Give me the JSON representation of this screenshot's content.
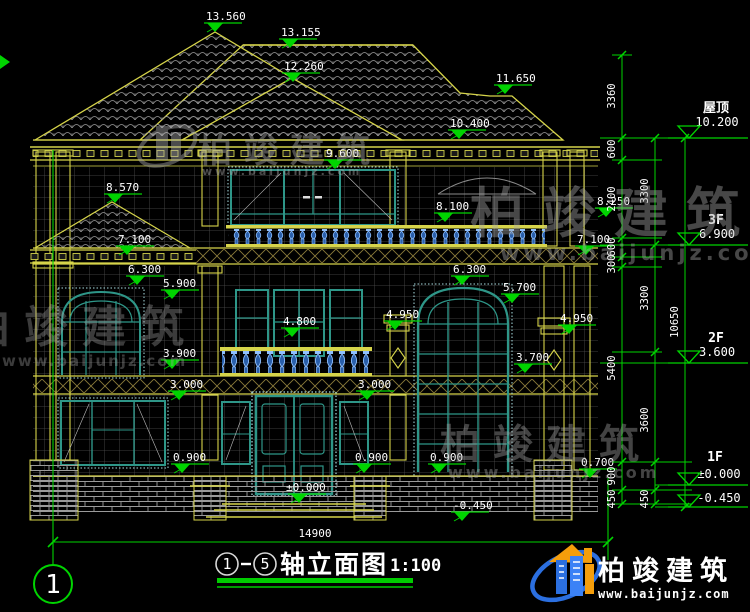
{
  "colors": {
    "dim_green": "#00d400",
    "cad_yellow": "#d6d44a",
    "window_teal": "#2e9688",
    "baluster_blue": "#5b8dd6",
    "logo_blue": "#2b6fe0",
    "logo_orange": "#f59e0b"
  },
  "watermark": {
    "brand": "柏竣建筑",
    "url": "www.baijunjz.com"
  },
  "logo": {
    "brand": "柏竣建筑",
    "url": "www.baijunjz.com"
  },
  "title_block": {
    "axis_start": "1",
    "axis_end": "5",
    "name": "轴立面图",
    "scale": "1:100"
  },
  "axis": {
    "left_bubble": "1"
  },
  "dims": {
    "bottom_total": "14900",
    "right_chain_inner": [
      "3360",
      "600",
      "2400",
      "600",
      "300",
      "5400",
      "900",
      "450"
    ],
    "right_chain_mid": [
      "3300",
      "3300",
      "3600",
      "450"
    ],
    "right_chain_outer": [
      "10650"
    ]
  },
  "levels": {
    "roof_label": "屋顶",
    "roof_value": "10.200",
    "f3_label": "3F",
    "f3_value": "6.900",
    "f2_label": "2F",
    "f2_value": "3.600",
    "f1_label": "1F",
    "f1_value": "±0.000",
    "ground_value": "-0.450"
  },
  "marks": {
    "m13560": "13.560",
    "m13155": "13.155",
    "m12260": "12.260",
    "m11650": "11.650",
    "m10400": "10.400",
    "m9600": "9.600",
    "m8570": "8.570",
    "m8250": "8.250",
    "m8100": "8.100",
    "m7100L": "7.100",
    "m7100R": "7.100",
    "m6300L": "6.300",
    "m6300R": "6.300",
    "m5900": "5.900",
    "m5700": "5.700",
    "m4950L": "4.950",
    "m4950R": "4.950",
    "m4800": "4.800",
    "m3900": "3.900",
    "m3700": "3.700",
    "m3000L": "3.000",
    "m3000R": "3.000",
    "m0900L": "0.900",
    "m0900C": "0.900",
    "m0900R": "0.900",
    "m0700": "0.700",
    "m0000": "±0.000",
    "mneg0450": "-0.450"
  }
}
